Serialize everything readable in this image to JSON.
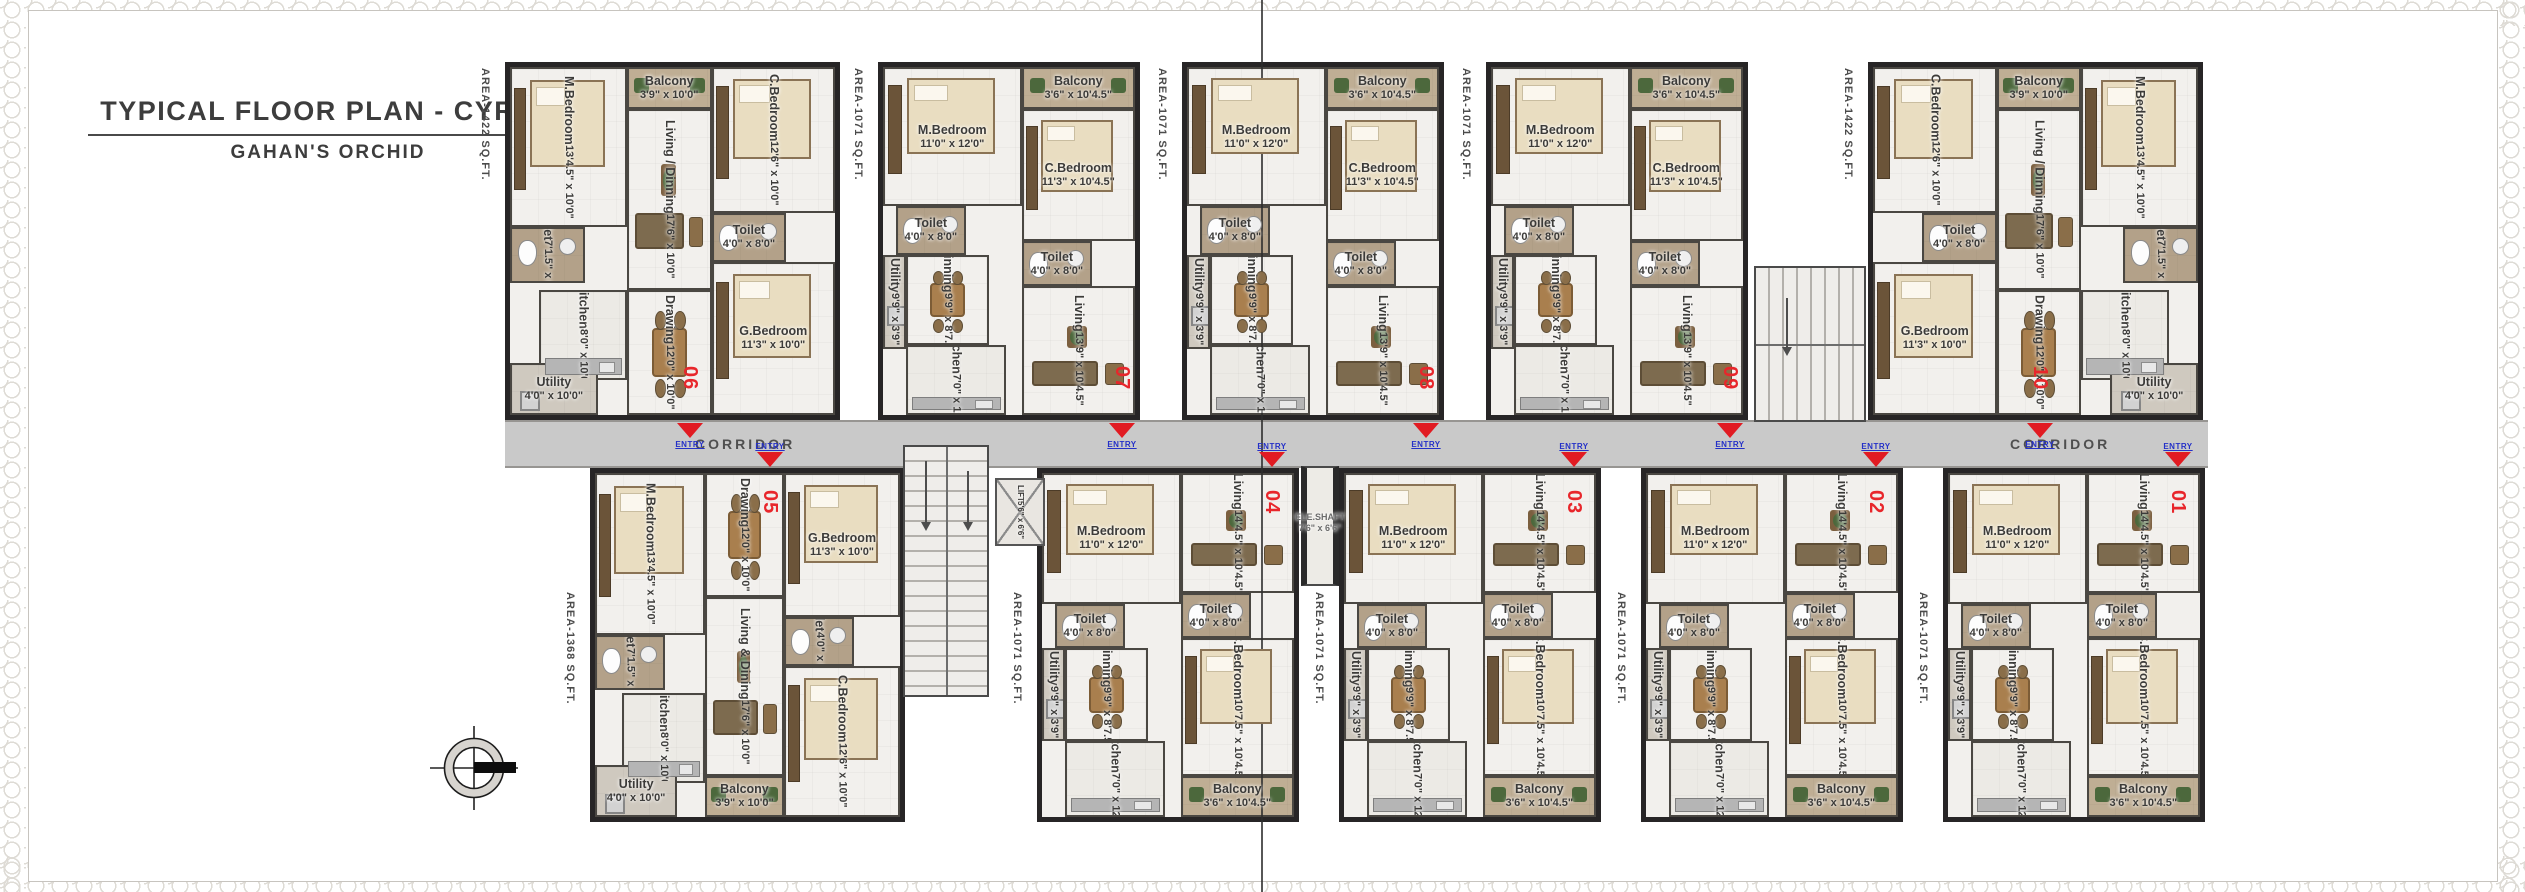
{
  "title": {
    "main": "TYPICAL FLOOR PLAN - CYRUS",
    "sub": "GAHAN'S ORCHID"
  },
  "corridor": {
    "label": "CORRIDOR"
  },
  "entry_label": "ENTRY",
  "core": {
    "lift_label": "LIFT",
    "lift_size": "5'6\" x 6'6\"",
    "ele_shaft_label": "ELE.SHAFT",
    "ele_shaft_size": "7'6\" x 6'6\""
  },
  "colors": {
    "accent_red": "#e11b22",
    "entry_blue": "#2430c8",
    "wall_dark": "#272526",
    "corridor_gray": "#c9c9c9",
    "floor_light": "#f2f0ed",
    "wet_area_tan": "#b3a189"
  },
  "unit_types": {
    "A_top": {
      "rooms": [
        {
          "key": "m-bedroom",
          "kind": "bed",
          "name": "M.Bedroom",
          "size": "13'4.5\" x 10'0\"",
          "rot": true,
          "x": 0,
          "y": 0,
          "w": 36,
          "h": 46
        },
        {
          "key": "balcony",
          "kind": "balcony",
          "name": "Balcony",
          "size": "3'9\" x 10'0\"",
          "rot": false,
          "x": 36,
          "y": 0,
          "w": 26,
          "h": 12
        },
        {
          "key": "living-dining",
          "kind": "living",
          "name": "Living / Dinning",
          "size": "17'6\" x 10'0\"",
          "rot": true,
          "x": 36,
          "y": 12,
          "w": 26,
          "h": 52
        },
        {
          "key": "c-bedroom",
          "kind": "bed",
          "name": "C.Bedroom",
          "size": "12'6\" x 10'0\"",
          "rot": true,
          "x": 62,
          "y": 0,
          "w": 38,
          "h": 42
        },
        {
          "key": "toilet-2",
          "kind": "toilet",
          "name": "Toilet",
          "size": "4'0\" x 8'0\"",
          "rot": false,
          "x": 62,
          "y": 42,
          "w": 23,
          "h": 14
        },
        {
          "key": "g-bedroom",
          "kind": "bed",
          "name": "G.Bedroom",
          "size": "11'3\" x 10'0\"",
          "rot": false,
          "x": 62,
          "y": 56,
          "w": 38,
          "h": 44
        },
        {
          "key": "toilet-1",
          "kind": "toilet",
          "name": "Toilet",
          "size": "7'1.5\" x 6'3\"",
          "rot": true,
          "x": 0,
          "y": 46,
          "w": 23,
          "h": 16
        },
        {
          "key": "kitchen",
          "kind": "kitchen",
          "name": "Kitchen",
          "size": "8'0\" x 10'0\"",
          "rot": true,
          "x": 9,
          "y": 64,
          "w": 27,
          "h": 26
        },
        {
          "key": "drawing",
          "kind": "drawing",
          "name": "Drawing",
          "size": "12'0\" x 10'0\"",
          "rot": true,
          "x": 36,
          "y": 64,
          "w": 26,
          "h": 36
        },
        {
          "key": "utility",
          "kind": "utility",
          "name": "Utility",
          "size": "4'0\" x 10'0\"",
          "rot": false,
          "x": 0,
          "y": 85,
          "w": 27,
          "h": 15
        }
      ]
    },
    "A_bot": {
      "rooms": [
        {
          "key": "m-bedroom",
          "kind": "bed",
          "name": "M.Bedroom",
          "size": "13'4.5\" x 10'0\"",
          "rot": true,
          "x": 0,
          "y": 0,
          "w": 36,
          "h": 47
        },
        {
          "key": "drawing",
          "kind": "drawing",
          "name": "Drawing",
          "size": "12'0\" x 10'0\"",
          "rot": true,
          "x": 36,
          "y": 0,
          "w": 26,
          "h": 36
        },
        {
          "key": "g-bedroom",
          "kind": "bed",
          "name": "G.Bedroom",
          "size": "11'3\" x 10'0\"",
          "rot": false,
          "x": 62,
          "y": 0,
          "w": 38,
          "h": 42
        },
        {
          "key": "toilet-2",
          "kind": "toilet",
          "name": "Toilet",
          "size": "4'0\" x 8'0\"",
          "rot": true,
          "x": 62,
          "y": 42,
          "w": 23,
          "h": 14
        },
        {
          "key": "living-dining",
          "kind": "living",
          "name": "Living & Dining",
          "size": "17'6\" x 10'0\"",
          "rot": true,
          "x": 36,
          "y": 36,
          "w": 26,
          "h": 52
        },
        {
          "key": "toilet-1",
          "kind": "toilet",
          "name": "Toilet",
          "size": "7'1.5\" x 6'3\"",
          "rot": true,
          "x": 0,
          "y": 47,
          "w": 23,
          "h": 16
        },
        {
          "key": "kitchen",
          "kind": "kitchen",
          "name": "Kitchen",
          "size": "8'0\" x 10'0\"",
          "rot": true,
          "x": 9,
          "y": 64,
          "w": 27,
          "h": 26
        },
        {
          "key": "c-bedroom",
          "kind": "bed",
          "name": "C.Bedroom",
          "size": "12'6\" x 10'0\"",
          "rot": true,
          "x": 62,
          "y": 56,
          "w": 38,
          "h": 44
        },
        {
          "key": "utility",
          "kind": "utility",
          "name": "Utility",
          "size": "4'0\" x 10'0\"",
          "rot": false,
          "x": 0,
          "y": 85,
          "w": 27,
          "h": 15
        },
        {
          "key": "balcony",
          "kind": "balcony",
          "name": "Balcony",
          "size": "3'9\" x 10'0\"",
          "rot": false,
          "x": 36,
          "y": 88,
          "w": 26,
          "h": 12
        }
      ]
    },
    "B_top": {
      "rooms": [
        {
          "key": "m-bedroom",
          "kind": "bed",
          "name": "M.Bedroom",
          "size": "11'0\" x 12'0\"",
          "rot": false,
          "x": 0,
          "y": 0,
          "w": 55,
          "h": 40
        },
        {
          "key": "balcony",
          "kind": "balcony",
          "name": "Balcony",
          "size": "3'6\" x 10'4.5\"",
          "rot": false,
          "x": 55,
          "y": 0,
          "w": 45,
          "h": 12
        },
        {
          "key": "c-bedroom",
          "kind": "bed",
          "name": "C.Bedroom",
          "size": "11'3\" x 10'4.5\"",
          "rot": false,
          "x": 55,
          "y": 12,
          "w": 45,
          "h": 38
        },
        {
          "key": "toilet-1",
          "kind": "toilet",
          "name": "Toilet",
          "size": "4'0\" x 8'0\"",
          "rot": false,
          "x": 5,
          "y": 40,
          "w": 28,
          "h": 14
        },
        {
          "key": "toilet-2",
          "kind": "toilet",
          "name": "Toilet",
          "size": "4'0\" x 8'0\"",
          "rot": false,
          "x": 55,
          "y": 50,
          "w": 28,
          "h": 13
        },
        {
          "key": "utility",
          "kind": "utility",
          "name": "Utility",
          "size": "9'9\" x 3'9\"",
          "rot": true,
          "x": 0,
          "y": 54,
          "w": 9,
          "h": 27
        },
        {
          "key": "dinning",
          "kind": "drawing",
          "name": "Dinning",
          "size": "9'9\" x 8'7.5\"",
          "rot": true,
          "x": 9,
          "y": 54,
          "w": 33,
          "h": 26
        },
        {
          "key": "kitchen",
          "kind": "kitchen",
          "name": "Kitchen",
          "size": "7'0\" x 12'0\"",
          "rot": true,
          "x": 9,
          "y": 80,
          "w": 40,
          "h": 20
        },
        {
          "key": "living",
          "kind": "living",
          "name": "Living",
          "size": "13'9\" x 10'4.5\"",
          "rot": true,
          "x": 55,
          "y": 63,
          "w": 45,
          "h": 37
        }
      ]
    },
    "B_bot": {
      "rooms": [
        {
          "key": "m-bedroom",
          "kind": "bed",
          "name": "M.Bedroom",
          "size": "11'0\" x 12'0\"",
          "rot": false,
          "x": 0,
          "y": 0,
          "w": 55,
          "h": 38
        },
        {
          "key": "living",
          "kind": "living",
          "name": "Living",
          "size": "14'4.5\" x 10'4.5\"",
          "rot": true,
          "x": 55,
          "y": 0,
          "w": 45,
          "h": 35
        },
        {
          "key": "toilet-1",
          "kind": "toilet",
          "name": "Toilet",
          "size": "4'0\" x 8'0\"",
          "rot": false,
          "x": 5,
          "y": 38,
          "w": 28,
          "h": 13
        },
        {
          "key": "toilet-2",
          "kind": "toilet",
          "name": "Toilet",
          "size": "4'0\" x 8'0\"",
          "rot": false,
          "x": 55,
          "y": 35,
          "w": 28,
          "h": 13
        },
        {
          "key": "utility",
          "kind": "utility",
          "name": "Utility",
          "size": "9'9\" x 3'9\"",
          "rot": true,
          "x": 0,
          "y": 51,
          "w": 9,
          "h": 27
        },
        {
          "key": "dinning",
          "kind": "drawing",
          "name": "Dinning",
          "size": "9'9\" x 8'7.5\"",
          "rot": true,
          "x": 9,
          "y": 51,
          "w": 33,
          "h": 27
        },
        {
          "key": "kitchen",
          "kind": "kitchen",
          "name": "Kitchen",
          "size": "7'0\" x 12'0\"",
          "rot": true,
          "x": 9,
          "y": 78,
          "w": 40,
          "h": 22
        },
        {
          "key": "c-bedroom",
          "kind": "bed",
          "name": "C.Bedroom",
          "size": "10'7.5\" x 10'4.5\"",
          "rot": true,
          "x": 55,
          "y": 48,
          "w": 45,
          "h": 40
        },
        {
          "key": "balcony",
          "kind": "balcony",
          "name": "Balcony",
          "size": "3'6\" x 10'4.5\"",
          "rot": false,
          "x": 55,
          "y": 88,
          "w": 45,
          "h": 12
        }
      ]
    }
  },
  "units": [
    {
      "id": "06",
      "area": "AREA-1422 SQ.FT.",
      "type": "A_top",
      "row": "top",
      "mirror": false,
      "x": 505,
      "y": 62,
      "w": 335,
      "h": 358,
      "num_x": 690
    },
    {
      "id": "07",
      "area": "AREA-1071 SQ.FT.",
      "type": "B_top",
      "row": "top",
      "mirror": false,
      "x": 878,
      "y": 62,
      "w": 262,
      "h": 358,
      "num_x": 1122
    },
    {
      "id": "08",
      "area": "AREA-1071 SQ.FT.",
      "type": "B_top",
      "row": "top",
      "mirror": false,
      "x": 1182,
      "y": 62,
      "w": 262,
      "h": 358,
      "num_x": 1426
    },
    {
      "id": "09",
      "area": "AREA-1071 SQ.FT.",
      "type": "B_top",
      "row": "top",
      "mirror": false,
      "x": 1486,
      "y": 62,
      "w": 262,
      "h": 358,
      "num_x": 1730
    },
    {
      "id": "10",
      "area": "AREA-1422 SQ.FT.",
      "type": "A_top",
      "row": "top",
      "mirror": true,
      "x": 1868,
      "y": 62,
      "w": 335,
      "h": 358,
      "num_x": 2040
    },
    {
      "id": "05",
      "area": "AREA-1368 SQ.FT.",
      "type": "A_bot",
      "row": "bot",
      "mirror": false,
      "x": 590,
      "y": 468,
      "w": 315,
      "h": 354,
      "num_x": 770
    },
    {
      "id": "04",
      "area": "AREA-1071 SQ.FT.",
      "type": "B_bot",
      "row": "bot",
      "mirror": false,
      "x": 1037,
      "y": 468,
      "w": 262,
      "h": 354,
      "num_x": 1272
    },
    {
      "id": "03",
      "area": "AREA-1071 SQ.FT.",
      "type": "B_bot",
      "row": "bot",
      "mirror": false,
      "x": 1339,
      "y": 468,
      "w": 262,
      "h": 354,
      "num_x": 1574
    },
    {
      "id": "02",
      "area": "AREA-1071 SQ.FT.",
      "type": "B_bot",
      "row": "bot",
      "mirror": false,
      "x": 1641,
      "y": 468,
      "w": 262,
      "h": 354,
      "num_x": 1876
    },
    {
      "id": "01",
      "area": "AREA-1071 SQ.FT.",
      "type": "B_bot",
      "row": "bot",
      "mirror": false,
      "x": 1943,
      "y": 468,
      "w": 262,
      "h": 354,
      "num_x": 2178
    }
  ],
  "corridor_label_positions_x": [
    695,
    2010
  ]
}
